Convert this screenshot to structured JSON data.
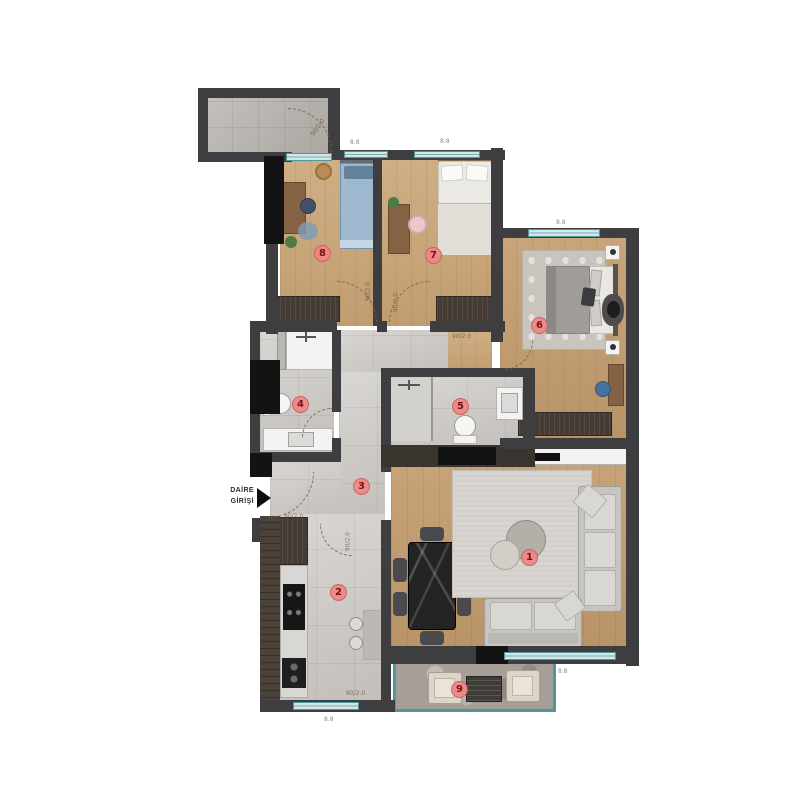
{
  "annotations": {
    "entrance_line1": "DAİRE",
    "entrance_line2": "GİRİŞİ",
    "door_size": "90/2.0",
    "door_size_kitchen": "60/2.0",
    "window_size": "8.8"
  },
  "markers": {
    "living_room": "1",
    "kitchen": "2",
    "hall": "3",
    "bathroom": "4",
    "ensuite_bathroom": "5",
    "master_bedroom": "6",
    "bedroom_2": "7",
    "bedroom_3": "8",
    "balcony": "9"
  },
  "colors": {
    "wall": "#3e3d3f",
    "wall_black": "#131313",
    "window_frame": "#4f979e",
    "window_fill": "#cfe8ea",
    "wood_floor": "#cba677",
    "tile_floor": "#cac7c2",
    "marker_bg": "#ee8686",
    "marker_text": "#7c1111"
  }
}
